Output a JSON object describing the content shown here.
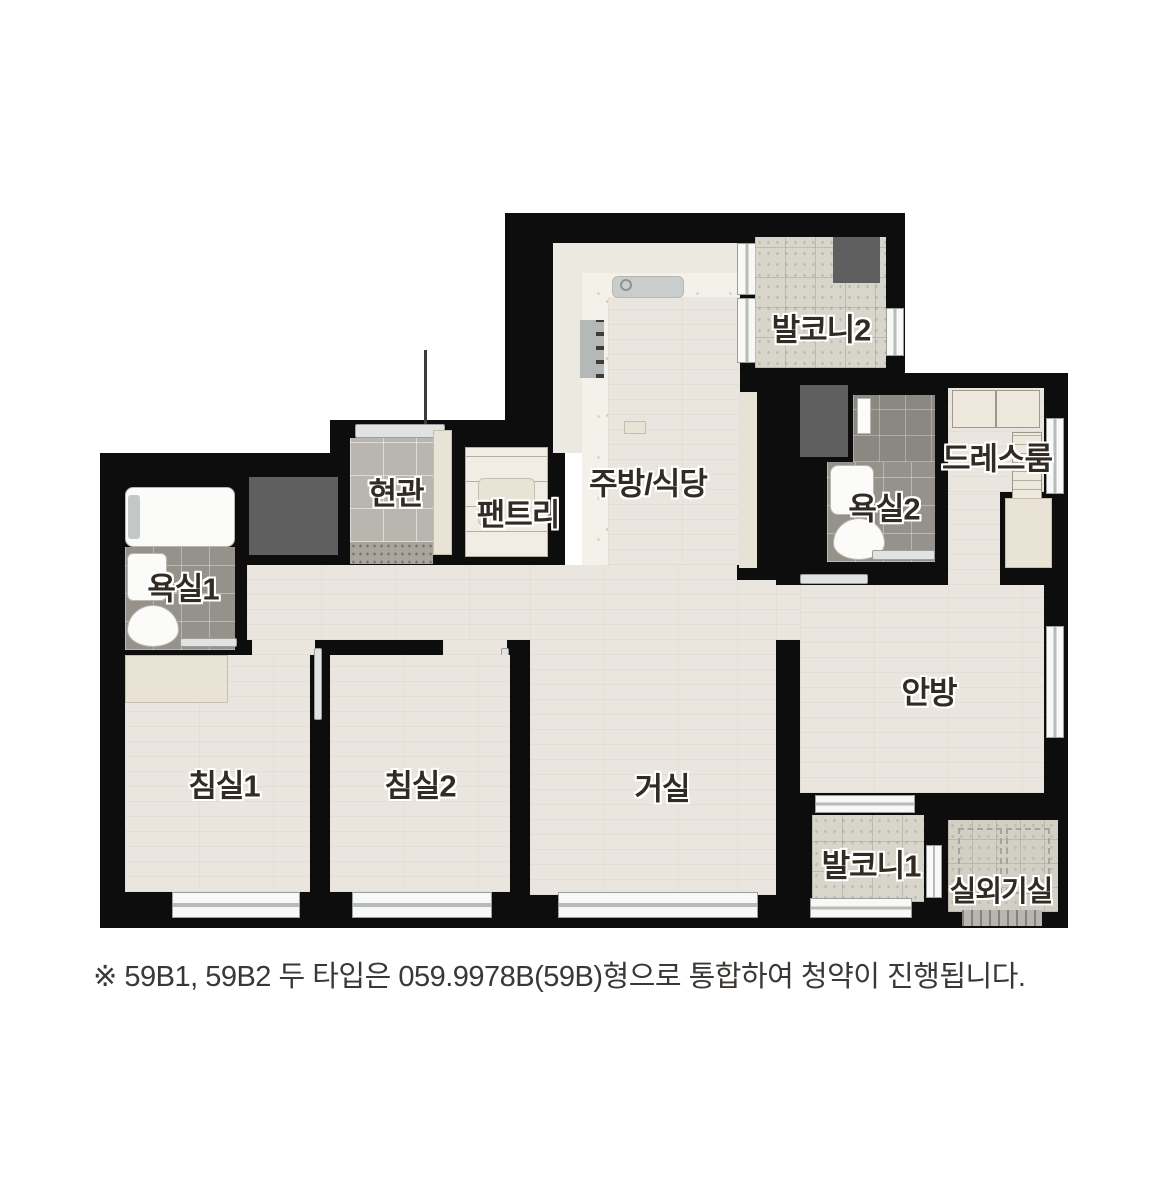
{
  "rooms": {
    "kitchen_dining": {
      "label": "주방/식당"
    },
    "balcony2": {
      "label": "발코니2"
    },
    "dressroom": {
      "label": "드레스룸"
    },
    "bathroom2": {
      "label": "욕실2"
    },
    "entrance": {
      "label": "현관"
    },
    "pantry": {
      "label": "팬트리"
    },
    "bathroom1": {
      "label": "욕실1"
    },
    "master_bedroom": {
      "label": "안방"
    },
    "living_room": {
      "label": "거실"
    },
    "bedroom1": {
      "label": "침실1"
    },
    "bedroom2": {
      "label": "침실2"
    },
    "balcony1": {
      "label": "발코니1"
    },
    "outdoor_unit_room": {
      "label": "실외기실"
    }
  },
  "footnote": {
    "text": "※ 59B1, 59B2 두 타입은 059.9978B(59B)형으로 통합하여 청약이 진행됩니다."
  },
  "colors": {
    "wall": "#0d0d0d",
    "wood_floor": "#eae6df",
    "kitchen_floor": "#f3f1ea",
    "bath_tile": "#95918b",
    "balcony_tile": "#d8d5cb",
    "entrance_tile": "#b9b6b0",
    "dark_fixture": "#5f5f5f",
    "label_text": "#322b23",
    "background": "#ffffff"
  }
}
